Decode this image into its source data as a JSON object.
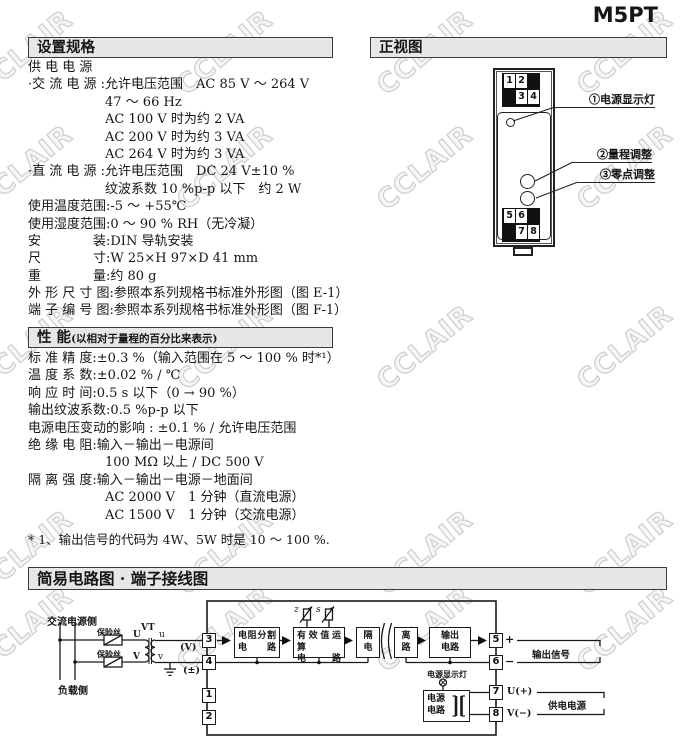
{
  "title": "M5PT",
  "watermark": {
    "text": "CCLAIR"
  },
  "specs": {
    "header": "设置规格",
    "lines": [
      {
        "t": "供 电 电 源",
        "i": 0
      },
      {
        "t": "·交 流 电 源 :允许电压范围　AC 85 V ～ 264 V",
        "i": 0
      },
      {
        "t": "47 ～ 66 Hz",
        "i": 1
      },
      {
        "t": "AC 100 V 时为约 2 VA",
        "i": 1
      },
      {
        "t": "AC 200 V 时为约 3 VA",
        "i": 1
      },
      {
        "t": "AC 264 V 时为约 3 VA",
        "i": 1
      },
      {
        "t": "·直 流 电 源 :允许电压范围　DC 24 V±10 %",
        "i": 0
      },
      {
        "t": "纹波系数 10 %p-p 以下　约 2 W",
        "i": 1
      },
      {
        "t": "使用温度范围:-5 ～ +55℃",
        "i": 0
      },
      {
        "t": "使用湿度范围:0 ～ 90 % RH（无冷凝）",
        "i": 0
      },
      {
        "t": "安　　　　装:DIN 导轨安装",
        "i": 0
      },
      {
        "t": "尺　　　　寸:W 25×H 97×D 41 mm",
        "i": 0
      },
      {
        "t": "重　　　　量:约 80 g",
        "i": 0
      },
      {
        "t": "外 形 尺 寸 图:参照本系列规格书标准外形图（图 E-1）",
        "i": 0
      },
      {
        "t": "端 子 编 号 图:参照本系列规格书标准外形图（图 F-1）",
        "i": 0
      }
    ]
  },
  "front_view": {
    "header": "正视图",
    "t1": "1",
    "t2": "2",
    "t3": "3",
    "t4": "4",
    "t5": "5",
    "t6": "6",
    "t7": "7",
    "t8": "8",
    "callout1": "①电源显示灯",
    "callout2": "②量程调整",
    "callout3": "③零点调整"
  },
  "performance": {
    "header": "性 能",
    "header_note": "(以相对于量程的百分比来表示)",
    "lines": [
      {
        "t": "标 准 精 度:±0.3 %（输入范围在 5 ～ 100 % 时*¹）",
        "i": 0
      },
      {
        "t": "温 度 系 数:±0.02 % / ℃",
        "i": 0
      },
      {
        "t": "响 应 时 间:0.5 s 以下（0 → 90 %）",
        "i": 0
      },
      {
        "t": "输出纹波系数:0.5 %p-p 以下",
        "i": 0
      },
      {
        "t": "电源电压变动的影响 : ±0.1 % / 允许电压范围",
        "i": 0
      },
      {
        "t": "绝 缘 电 阻:输入－输出－电源间",
        "i": 0
      },
      {
        "t": "100 MΩ 以上 /  DC 500 V",
        "i": 1
      },
      {
        "t": "隔 离 强 度:输入－输出－电源－地面间",
        "i": 0
      },
      {
        "t": "AC 2000 V　1 分钟（直流电源）",
        "i": 1
      },
      {
        "t": "AC 1500 V　1 分钟（交流电源）",
        "i": 1
      }
    ],
    "footnote": "* 1、输出信号的代码为 4W、5W 时是 10 ～ 100 %."
  },
  "circuit": {
    "header": "简易电路图 · 端子接线图",
    "ac_side": "交流电源侧",
    "load_side": "负载侧",
    "fuse1": "保险丝",
    "fuse2": "保险丝",
    "vt": "VT",
    "U": "U",
    "V": "V",
    "u": "u",
    "v": "v",
    "volt": "(V)",
    "pm": "(±)",
    "t1": "1",
    "t2": "2",
    "t3": "3",
    "t4": "4",
    "t5": "5",
    "t6": "6",
    "t7": "7",
    "t8": "8",
    "box_divider_l1": "电阻分割",
    "box_divider_l2": "电　路",
    "box_rms_l1": "有效值运算",
    "box_rms_l2": "电　　路",
    "box_iso_l1": "隔",
    "box_iso_l2": "电",
    "box_iso_r1": "离",
    "box_iso_r2": "路",
    "box_out_l1": "输出",
    "box_out_l2": "电路",
    "box_pwr_l1": "电源",
    "box_pwr_l2": "电路",
    "z": "z",
    "s": "s",
    "lamp_label": "电源显示灯",
    "plus": "+",
    "minus": "−",
    "u_plus": "U(+)",
    "v_minus": "V(−)",
    "out_signal": "输出信号",
    "supply": "供电电源"
  }
}
